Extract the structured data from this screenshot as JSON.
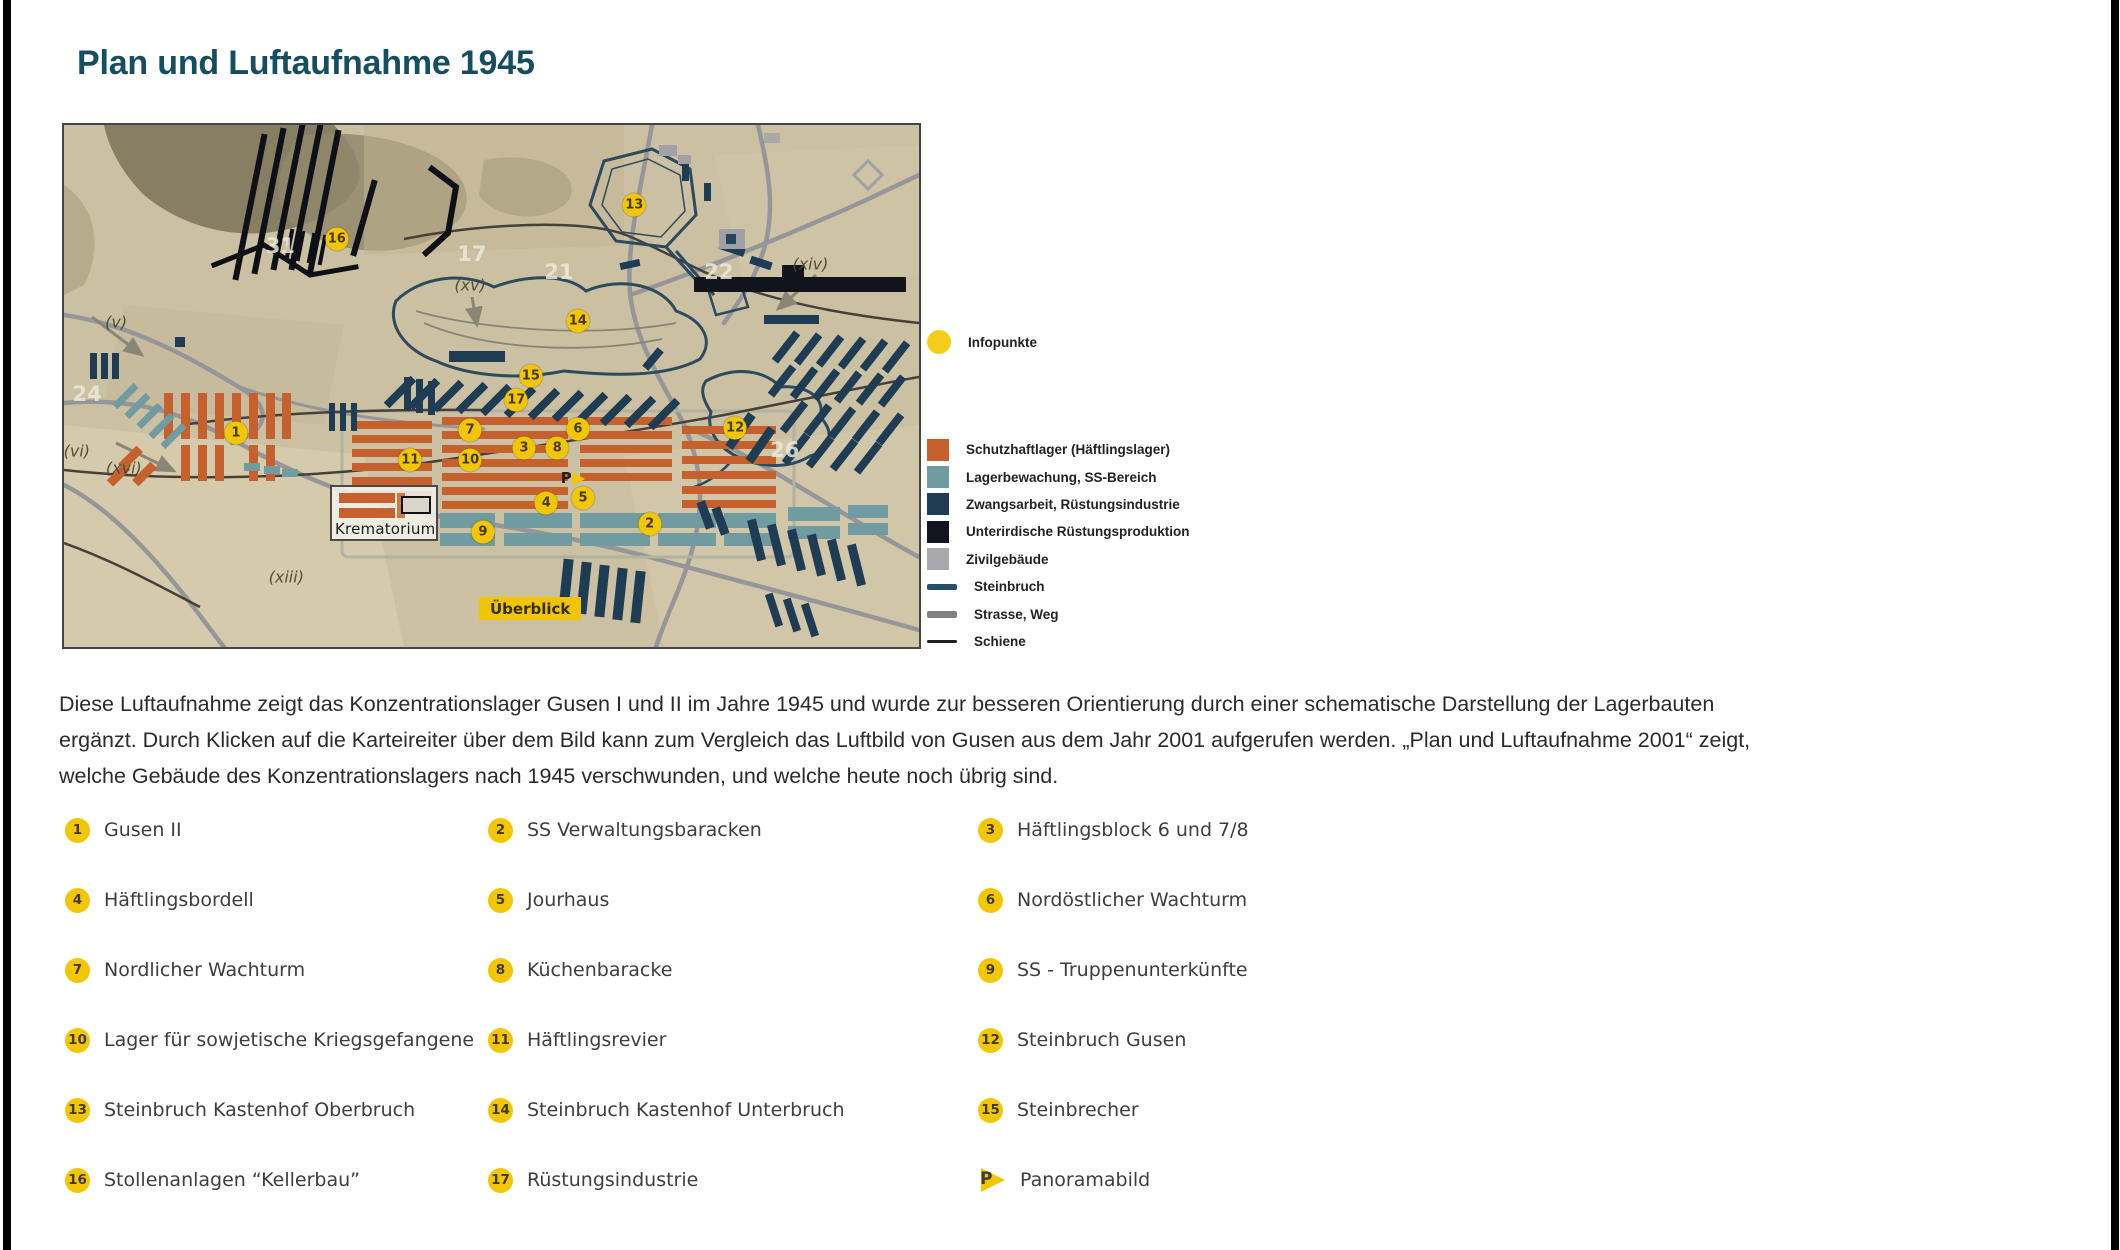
{
  "page": {
    "title": "Plan und Luftaufnahme 1945"
  },
  "colors": {
    "title_teal": "#154e60",
    "marker_yellow": "#f2c702",
    "infopunkte_yellow": "#f5cd1b",
    "tab_yellow": "#f2c504"
  },
  "map": {
    "krematorium_label": "Krematorium",
    "ueberblick_label": "Überblick",
    "markers": [
      {
        "id": "1",
        "x": 20.1,
        "y": 59.0
      },
      {
        "id": "2",
        "x": 68.5,
        "y": 76.4
      },
      {
        "id": "3",
        "x": 53.8,
        "y": 61.9
      },
      {
        "id": "4",
        "x": 56.4,
        "y": 72.4
      },
      {
        "id": "5",
        "x": 60.7,
        "y": 71.5
      },
      {
        "id": "6",
        "x": 60.1,
        "y": 58.2
      },
      {
        "id": "7",
        "x": 47.5,
        "y": 58.4
      },
      {
        "id": "8",
        "x": 57.7,
        "y": 61.9
      },
      {
        "id": "9",
        "x": 49.0,
        "y": 78.0
      },
      {
        "id": "10",
        "x": 47.5,
        "y": 64.2
      },
      {
        "id": "11",
        "x": 40.5,
        "y": 64.2
      },
      {
        "id": "12",
        "x": 78.5,
        "y": 58.0
      },
      {
        "id": "13",
        "x": 66.7,
        "y": 15.3
      },
      {
        "id": "14",
        "x": 60.1,
        "y": 37.5
      },
      {
        "id": "15",
        "x": 54.6,
        "y": 48.1
      },
      {
        "id": "16",
        "x": 31.9,
        "y": 21.8
      },
      {
        "id": "17",
        "x": 52.9,
        "y": 52.7
      },
      {
        "id": "P",
        "x": 59.5,
        "y": 67.8
      }
    ],
    "annotations": [
      {
        "text": "(v)",
        "x": 6.1,
        "y": 37.7,
        "tone": "ink"
      },
      {
        "text": "(vi)",
        "x": 1.5,
        "y": 62.5,
        "tone": "ink"
      },
      {
        "text": "(xvi)",
        "x": 7.0,
        "y": 65.7,
        "tone": "ink"
      },
      {
        "text": "(xiii)",
        "x": 26.0,
        "y": 86.6,
        "tone": "ink"
      },
      {
        "text": "(xv)",
        "x": 47.5,
        "y": 30.7,
        "tone": "ink"
      },
      {
        "text": "(xiv)",
        "x": 87.3,
        "y": 26.6,
        "tone": "ink"
      },
      {
        "text": "17",
        "x": 47.7,
        "y": 24.7,
        "tone": "faint"
      },
      {
        "text": "21",
        "x": 57.9,
        "y": 28.2,
        "tone": "faint"
      },
      {
        "text": "22",
        "x": 76.6,
        "y": 28.2,
        "tone": "faint"
      },
      {
        "text": "24",
        "x": 2.7,
        "y": 51.5,
        "tone": "faint"
      },
      {
        "text": "26",
        "x": 84.3,
        "y": 62.3,
        "tone": "faint"
      },
      {
        "text": "31",
        "x": 25.3,
        "y": 23.2,
        "tone": "faint"
      }
    ]
  },
  "legend": {
    "infopunkte_label": "Infopunkte",
    "infopunkte_color": "#f5cd1b",
    "items": [
      {
        "label": "Schutzhaftlager (Häftlingslager)",
        "color": "#c6612e",
        "type": "square"
      },
      {
        "label": "Lagerbewachung, SS-Bereich",
        "color": "#6f9ba1",
        "type": "square"
      },
      {
        "label": "Zwangsarbeit, Rüstungsindustrie",
        "color": "#1e3d54",
        "type": "square"
      },
      {
        "label": "Unterirdische Rüstungsproduktion",
        "color": "#14141f",
        "type": "square"
      },
      {
        "label": "Zivilgebäude",
        "color": "#a7a9ac",
        "type": "square"
      },
      {
        "label": "Steinbruch",
        "color": "#24506b",
        "type": "line",
        "thickness": 6
      },
      {
        "label": "Strasse, Weg",
        "color": "#808285",
        "type": "line",
        "thickness": 7
      },
      {
        "label": "Schiene",
        "color": "#231f20",
        "type": "line",
        "thickness": 3
      }
    ]
  },
  "description": {
    "lines": [
      "Diese Luftaufnahme zeigt das Konzentrationslager Gusen I und II im Jahre 1945 und wurde zur besseren Orientierung durch einer schematische Darstellung der Lagerbauten",
      "ergänzt. Durch Klicken auf die Karteireiter über dem Bild kann zum Vergleich das Luftbild von Gusen aus dem Jahr 2001 aufgerufen werden. „Plan und Luftaufnahme 2001“ zeigt,",
      "welche Gebäude des Konzentrationslagers nach 1945 verschwunden, und welche heute noch übrig sind."
    ]
  },
  "locations": [
    {
      "num": "1",
      "label": "Gusen II"
    },
    {
      "num": "2",
      "label": "SS Verwaltungsbaracken"
    },
    {
      "num": "3",
      "label": "Häftlingsblock 6 und 7/8"
    },
    {
      "num": "4",
      "label": "Häftlingsbordell"
    },
    {
      "num": "5",
      "label": "Jourhaus"
    },
    {
      "num": "6",
      "label": "Nordöstlicher Wachturm"
    },
    {
      "num": "7",
      "label": "Nordlicher Wachturm"
    },
    {
      "num": "8",
      "label": "Küchenbaracke"
    },
    {
      "num": "9",
      "label": "SS - Truppenunterkünfte"
    },
    {
      "num": "10",
      "label": "Lager für sowjetische Kriegsgefangene"
    },
    {
      "num": "11",
      "label": "Häftlingsrevier"
    },
    {
      "num": "12",
      "label": "Steinbruch Gusen"
    },
    {
      "num": "13",
      "label": "Steinbruch Kastenhof Oberbruch"
    },
    {
      "num": "14",
      "label": "Steinbruch Kastenhof Unterbruch"
    },
    {
      "num": "15",
      "label": "Steinbrecher"
    },
    {
      "num": "16",
      "label": "Stollenanlagen “Kellerbau”"
    },
    {
      "num": "17",
      "label": "Rüstungsindustrie"
    },
    {
      "num": "P",
      "label": "Panoramabild",
      "icon": "pano-flag"
    }
  ]
}
